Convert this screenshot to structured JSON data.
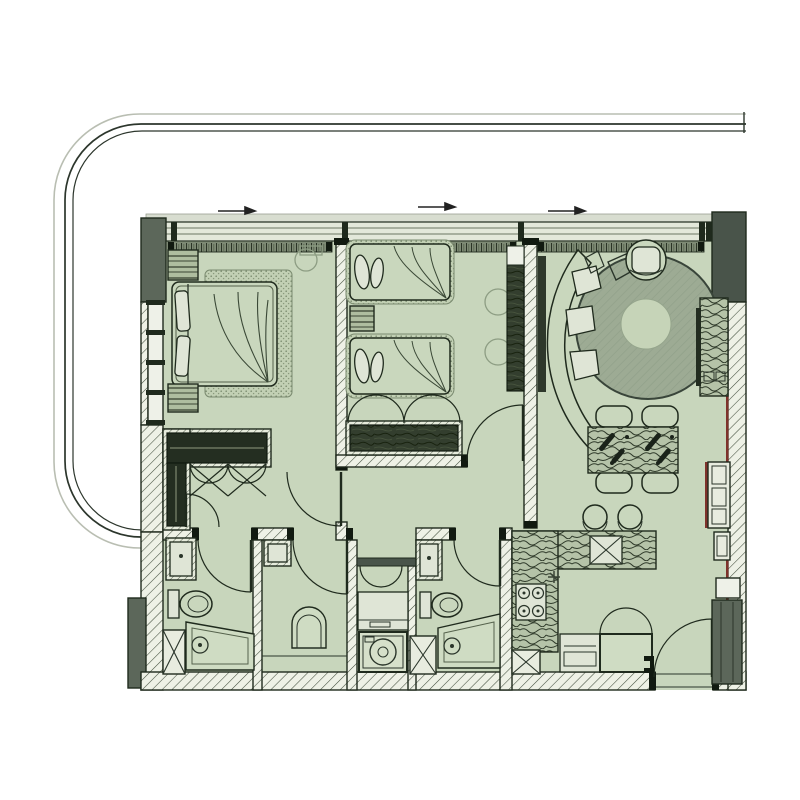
{
  "meta": {
    "title": "Two-bedroom apartment floor plan with wrap-around terrace",
    "type": "architectural-floor-plan",
    "canvas": "800x800"
  },
  "palette": {
    "background": "#ffffff",
    "floor": "#c8d6bc",
    "wall_hatch_bg": "#eef1e6",
    "hatch_line": "#44503f",
    "gray_wall": "#5c675a",
    "gray_wall_dark": "#49544a",
    "line_dark": "#1f2a1d",
    "rug": "#9dab94",
    "rug_inner": "#c6d4b8",
    "wood": "#b5c3a8",
    "wood_line": "#2e3929",
    "dark_wardrobe": "#242e21",
    "window_band": "#e3e8da",
    "curtain_strip": "#7d8a74",
    "accent_red": "#7e322b",
    "balcony_dark": "#2c362c",
    "balcony_light": "#b9beb2"
  },
  "balcony": {
    "description": "rounded terrace outline wrapping top and left of plan",
    "line_count": 3
  },
  "windows": {
    "top_opening_arrows": 3,
    "left_pane_count": 4
  },
  "rooms": [
    {
      "id": "master-bedroom",
      "name": "Master Bedroom",
      "furniture": [
        "double bed",
        "two nightstands",
        "area rug",
        "tall wardrobe",
        "reading chair"
      ]
    },
    {
      "id": "walk-in-closet",
      "name": "Walk-in Closet",
      "furniture": [
        "L-shaped dark wardrobe",
        "bifold closet doors",
        "swing door"
      ]
    },
    {
      "id": "bedroom-2",
      "name": "Second Bedroom",
      "furniture": [
        "twin bed",
        "twin bed",
        "nightstand",
        "wardrobe with bifold doors",
        "two chairs",
        "tall side wardrobe"
      ]
    },
    {
      "id": "living-room",
      "name": "Living Room",
      "furniture": [
        "curved sofa",
        "armchair",
        "round area rug",
        "TV console",
        "shelving unit"
      ]
    },
    {
      "id": "dining-area",
      "name": "Dining Area",
      "furniture": [
        "dining table",
        "four chairs",
        "two bar stools",
        "cutlery setting"
      ]
    },
    {
      "id": "kitchen",
      "name": "Kitchen",
      "furniture": [
        "L-shaped counter",
        "double sink",
        "four-burner stove",
        "service shaft"
      ]
    },
    {
      "id": "master-bathroom",
      "name": "Master Bathroom",
      "furniture": [
        "vanity",
        "toilet",
        "walk-in shower",
        "duct shaft"
      ]
    },
    {
      "id": "wc",
      "name": "WC",
      "furniture": [
        "washbasin",
        "wall-hung toilet"
      ]
    },
    {
      "id": "laundry",
      "name": "Laundry Niche",
      "furniture": [
        "washing machine",
        "cabinet",
        "bifold doors"
      ]
    },
    {
      "id": "bathroom-2",
      "name": "Second Bathroom",
      "furniture": [
        "vanity",
        "toilet",
        "shower",
        "duct shaft"
      ]
    },
    {
      "id": "entry",
      "name": "Entry",
      "furniture": [
        "entry door",
        "shoe cabinet",
        "tall gray cabinet"
      ]
    }
  ]
}
